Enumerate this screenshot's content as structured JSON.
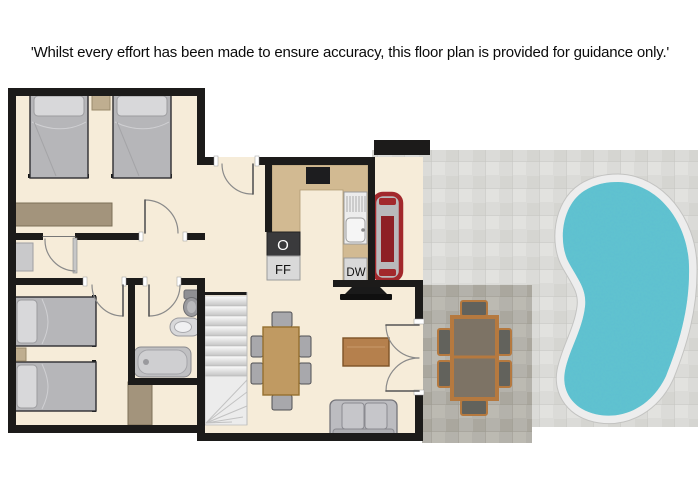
{
  "disclaimer": "'Whilst every effort has been made to ensure accuracy, this floor plan is provided for guidance only.'",
  "kitchen": {
    "oven_label": "O",
    "fridge_freezer_label": "FF",
    "dishwasher_label": "DW"
  },
  "colors": {
    "wall": "#1c1b1a",
    "floor": "#f6ecd9",
    "counter": "#d2ba92",
    "wood_furniture": "#a3947c",
    "bed_gray": "#b6b6b9",
    "patio_tile_light": "#dbdbd8",
    "patio_tile_dark": "#b4b2ab",
    "pool_water": "#5fc0d0",
    "pool_ring": "#ededed",
    "bbq_red": "#a2282c",
    "dining_table_wood": "#c09a62",
    "outdoor_wood": "#b5793f",
    "coffee_table_wood": "#b5804d",
    "sofa_gray": "#bcbcc0"
  }
}
